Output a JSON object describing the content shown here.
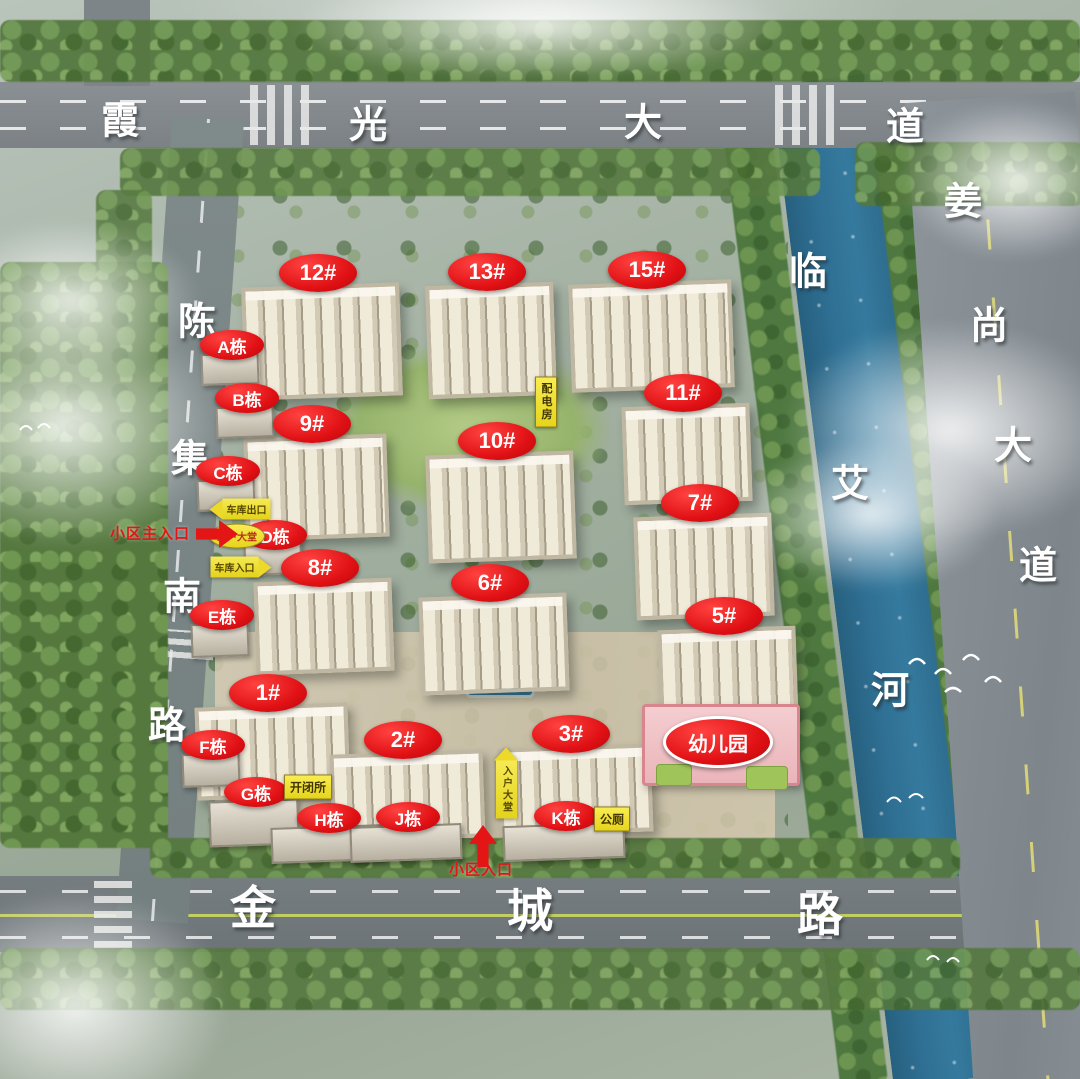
{
  "colors": {
    "label_red": "#e01014",
    "label_yellow": "#f0df2e",
    "road_text": "#ffffff",
    "river_blue": "#2f7094",
    "entrance_red": "#e31515"
  },
  "roads": [
    {
      "id": "xiaguang-avenue",
      "name": "霞光大道",
      "size": "",
      "chars": [
        {
          "ch": "霞",
          "x": 120,
          "y": 117
        },
        {
          "ch": "光",
          "x": 368,
          "y": 121
        },
        {
          "ch": "大",
          "x": 643,
          "y": 119
        },
        {
          "ch": "道",
          "x": 905,
          "y": 123
        }
      ]
    },
    {
      "id": "jiangshang-avenue",
      "name": "姜尚大道",
      "size": "",
      "chars": [
        {
          "ch": "姜",
          "x": 963,
          "y": 198
        },
        {
          "ch": "尚",
          "x": 989,
          "y": 322
        },
        {
          "ch": "大",
          "x": 1013,
          "y": 442
        },
        {
          "ch": "道",
          "x": 1038,
          "y": 562
        }
      ]
    },
    {
      "id": "chenji-south-road",
      "name": "陈集南路",
      "size": "",
      "chars": [
        {
          "ch": "陈",
          "x": 197,
          "y": 318
        },
        {
          "ch": "集",
          "x": 190,
          "y": 455
        },
        {
          "ch": "南",
          "x": 182,
          "y": 593
        },
        {
          "ch": "路",
          "x": 167,
          "y": 722
        }
      ]
    },
    {
      "id": "jincheng-road",
      "name": "金城路",
      "size": "big",
      "chars": [
        {
          "ch": "金",
          "x": 253,
          "y": 905
        },
        {
          "ch": "城",
          "x": 530,
          "y": 908
        },
        {
          "ch": "路",
          "x": 820,
          "y": 912
        }
      ]
    },
    {
      "id": "linai-river",
      "name": "临艾河",
      "size": "",
      "chars": [
        {
          "ch": "临",
          "x": 808,
          "y": 268
        },
        {
          "ch": "艾",
          "x": 850,
          "y": 480
        },
        {
          "ch": "河",
          "x": 890,
          "y": 687
        }
      ]
    }
  ],
  "buildings": [
    {
      "label": "12#",
      "x": 318,
      "y": 273,
      "tw": 150,
      "th": 105
    },
    {
      "label": "13#",
      "x": 487,
      "y": 272,
      "tw": 120,
      "th": 105
    },
    {
      "label": "15#",
      "x": 647,
      "y": 270,
      "tw": 155,
      "th": 100
    },
    {
      "label": "9#",
      "x": 312,
      "y": 424,
      "tw": 135,
      "th": 95
    },
    {
      "label": "11#",
      "x": 683,
      "y": 393,
      "tw": 120,
      "th": 90
    },
    {
      "label": "10#",
      "x": 497,
      "y": 441,
      "tw": 140,
      "th": 100
    },
    {
      "label": "7#",
      "x": 700,
      "y": 503,
      "tw": 130,
      "th": 95
    },
    {
      "label": "8#",
      "x": 320,
      "y": 568,
      "tw": 130,
      "th": 85
    },
    {
      "label": "6#",
      "x": 490,
      "y": 583,
      "tw": 140,
      "th": 90
    },
    {
      "label": "5#",
      "x": 724,
      "y": 616,
      "tw": 130,
      "th": 85
    },
    {
      "label": "1#",
      "x": 268,
      "y": 693,
      "tw": 145,
      "th": 85
    },
    {
      "label": "2#",
      "x": 403,
      "y": 740,
      "tw": 145,
      "th": 80
    },
    {
      "label": "3#",
      "x": 571,
      "y": 734,
      "tw": 145,
      "th": 80
    }
  ],
  "blocks": [
    {
      "label": "A栋",
      "x": 232,
      "y": 345,
      "sw": 54,
      "sh": 28
    },
    {
      "label": "B栋",
      "x": 247,
      "y": 398,
      "sw": 54,
      "sh": 28
    },
    {
      "label": "C栋",
      "x": 228,
      "y": 471,
      "sw": 54,
      "sh": 28
    },
    {
      "label": "D栋",
      "x": 275,
      "y": 535,
      "sw": 54,
      "sh": 28
    },
    {
      "label": "E栋",
      "x": 222,
      "y": 615,
      "sw": 54,
      "sh": 30
    },
    {
      "label": "F栋",
      "x": 213,
      "y": 745,
      "sw": 54,
      "sh": 30
    },
    {
      "label": "G栋",
      "x": 256,
      "y": 792,
      "sw": 86,
      "sh": 42
    },
    {
      "label": "H栋",
      "x": 329,
      "y": 818,
      "sw": 108,
      "sh": 32
    },
    {
      "label": "J栋",
      "x": 408,
      "y": 817,
      "sw": 108,
      "sh": 32
    },
    {
      "label": "K栋",
      "x": 566,
      "y": 816,
      "sw": 118,
      "sh": 32
    }
  ],
  "facilities": [
    {
      "label": "幼儿园",
      "x": 718,
      "y": 742,
      "type": "kindergarten"
    },
    {
      "label": "开闭所",
      "x": 308,
      "y": 787,
      "type": "yellow"
    },
    {
      "label": "公厕",
      "x": 612,
      "y": 819,
      "type": "yellow"
    },
    {
      "label": "配电房",
      "x": 546,
      "y": 402,
      "type": "yellow-vertical"
    }
  ],
  "garage_labels": [
    {
      "label": "车库出口",
      "x": 240,
      "y": 509,
      "type": "arrow-left"
    },
    {
      "label": "入户大堂",
      "x": 237,
      "y": 536,
      "type": "oval"
    },
    {
      "label": "车库入口",
      "x": 241,
      "y": 567,
      "type": "arrow-right"
    },
    {
      "label": "入户大堂",
      "x": 506,
      "y": 783,
      "type": "arrow-up"
    }
  ],
  "entrances": [
    {
      "label": "小区主入口",
      "tx": 150,
      "ty": 533,
      "ax": 217,
      "ay": 534,
      "dir": "right"
    },
    {
      "label": "小区入口",
      "tx": 481,
      "ty": 869,
      "ax": 483,
      "ay": 846,
      "dir": "up"
    }
  ]
}
